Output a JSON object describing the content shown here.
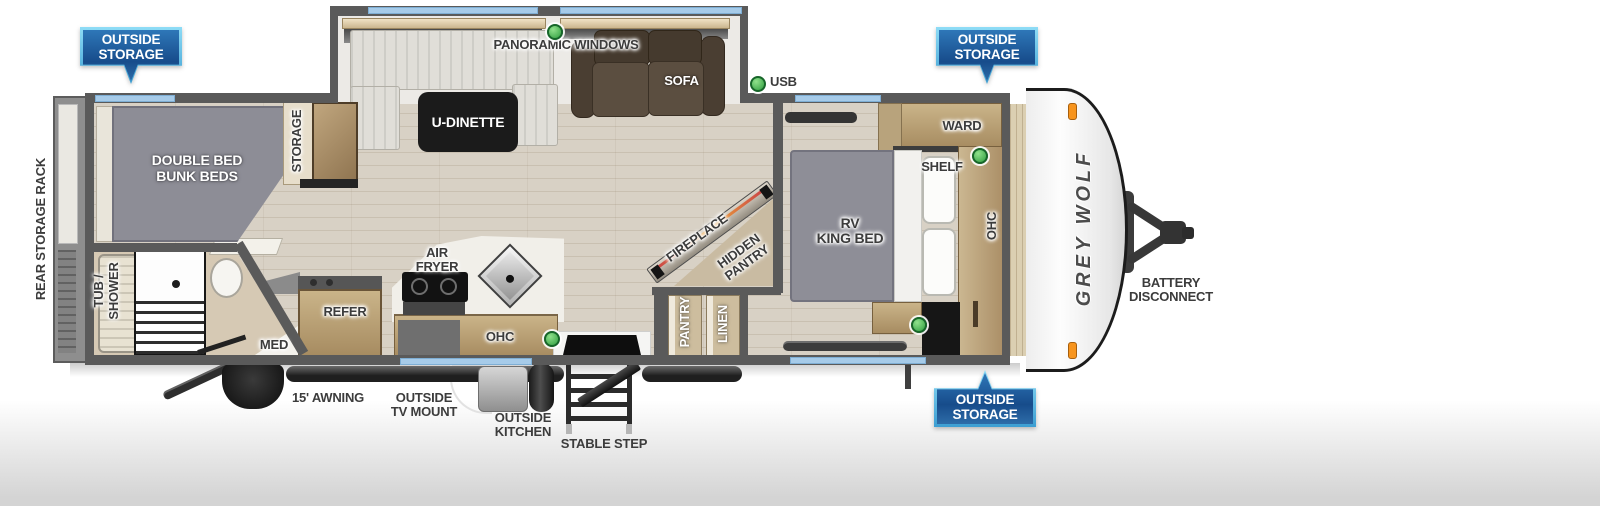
{
  "title": "Grey Wolf travel trailer floor plan",
  "colors": {
    "banner_blue": "#1c518e",
    "banner_border_blue": "#7fd4f2",
    "window_blue": "#a6cbe9",
    "led_green": "#3cb54a",
    "wall_gray": "#5a5a5a",
    "wood_tan": "#b89d72",
    "floor_beige": "#d8d1c5",
    "bed_gray": "#8e8e97",
    "sofa_brown": "#52463a",
    "clearance_light_orange": "#f7941d"
  },
  "banners": {
    "top_left": {
      "line1": "OUTSIDE",
      "line2": "STORAGE"
    },
    "top_right": {
      "line1": "OUTSIDE",
      "line2": "STORAGE"
    },
    "bottom_right": {
      "line1": "OUTSIDE",
      "line2": "STORAGE"
    }
  },
  "exterior": {
    "rear_storage_rack": "REAR STORAGE RACK",
    "awning": "15' AWNING",
    "outside_tv_mount": {
      "line1": "OUTSIDE",
      "line2": "TV MOUNT"
    },
    "outside_kitchen": {
      "line1": "OUTSIDE",
      "line2": "KITCHEN"
    },
    "stable_step": "STABLE STEP",
    "battery_disconnect": {
      "line1": "BATTERY",
      "line2": "DISCONNECT"
    },
    "logo": "GREY WOLF"
  },
  "living": {
    "panoramic_windows": "PANORAMIC WINDOWS",
    "sofa": "SOFA",
    "u_dinette": "U-DINETTE",
    "usb": "USB",
    "fireplace": "FIREPLACE",
    "hidden_pantry": {
      "line1": "HIDDEN",
      "line2": "PANTRY"
    }
  },
  "kitchen": {
    "refer": "REFER",
    "air_fryer": {
      "line1": "AIR",
      "line2": "FRYER"
    },
    "ohc": "OHC",
    "pantry": "PANTRY",
    "linen": "LINEN"
  },
  "bunk_room": {
    "bunk": {
      "line1": "DOUBLE BED",
      "line2": "BUNK BEDS"
    },
    "storage": "STORAGE"
  },
  "bathroom": {
    "tub_shower": {
      "line1": "TUB /",
      "line2": "SHOWER"
    },
    "med": "MED"
  },
  "bedroom": {
    "rv_king_bed": {
      "line1": "RV",
      "line2": "KING BED"
    },
    "ward": "WARD",
    "shelf": "SHELF",
    "ohc": "OHC"
  }
}
